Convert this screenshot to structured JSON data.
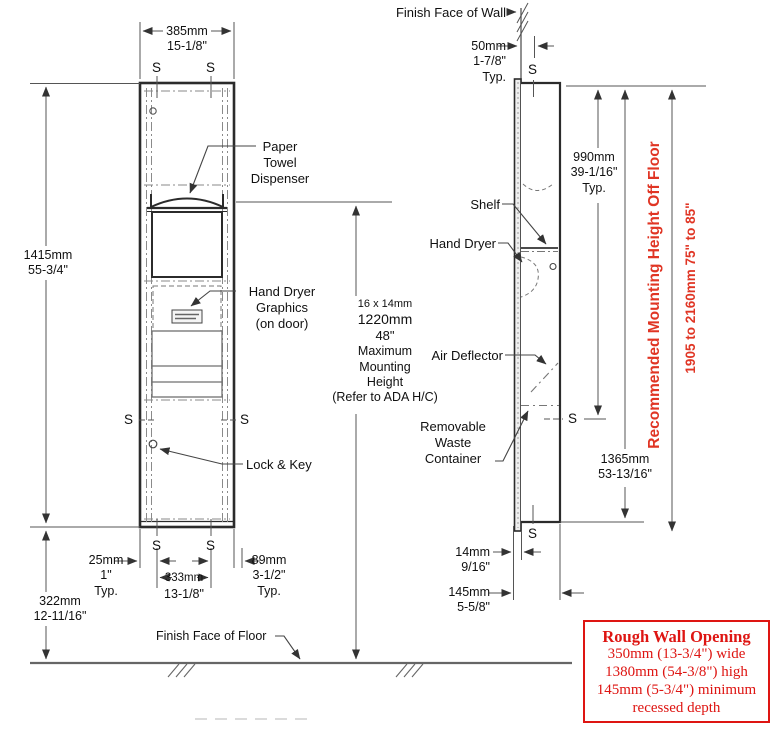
{
  "drawing": {
    "s_marker": "S",
    "front": {
      "width_mm": "385mm",
      "width_in": "15-1/8\"",
      "height_mm": "1415mm",
      "height_in": "55-3/4\"",
      "floor_mm": "322mm",
      "floor_in": "12-11/16\"",
      "inset": {
        "mm": "25mm",
        "in": "1\"",
        "typ": "Typ."
      },
      "stud": {
        "mm": "333mm",
        "in": "13-1/8\""
      },
      "side_off": {
        "mm": "89mm",
        "in": "3-1/2\"",
        "typ": "Typ."
      },
      "paper_towel": [
        "Paper",
        "Towel",
        "Dispenser"
      ],
      "hand_dryer_graphics": [
        "Hand Dryer",
        "Graphics",
        "(on door)"
      ],
      "lock_key": "Lock & Key",
      "floor_label": "Finish Face of Floor",
      "mount": [
        "16 x 14mm",
        "1220mm",
        "48\"",
        "Maximum",
        "Mounting",
        "Height",
        "(Refer to ADA H/C)"
      ]
    },
    "side": {
      "wall_label": "Finish Face of Wall",
      "wall_inset": {
        "mm": "50mm",
        "in": "1-7/8\"",
        "typ": "Typ."
      },
      "upper": {
        "mm": "990mm",
        "in": "39-1/16\"",
        "typ": "Typ."
      },
      "shelf": "Shelf",
      "hand_dryer": "Hand Dryer",
      "air_deflector": "Air Deflector",
      "waste": [
        "Removable",
        "Waste",
        "Container"
      ],
      "height": {
        "mm": "1365mm",
        "in": "53-13/16\""
      },
      "flange": {
        "mm": "14mm",
        "in": "9/16\""
      },
      "depth": {
        "mm": "145mm",
        "in": "5-5/8\""
      }
    },
    "recommended": {
      "title": "Recommended Mounting Height Off Floor",
      "range": "1905 to 2160mm  75\" to 85\""
    },
    "rough_opening": {
      "title": "Rough Wall Opening",
      "lines": [
        "350mm (13-3/4\") wide",
        "1380mm (54-3/8\") high",
        "145mm (5-3/4\") minimum",
        "recessed depth"
      ]
    },
    "colors": {
      "red": "#e03524",
      "box_red": "#de1512",
      "line": "#2b2b2b",
      "dim": "#666666"
    }
  }
}
